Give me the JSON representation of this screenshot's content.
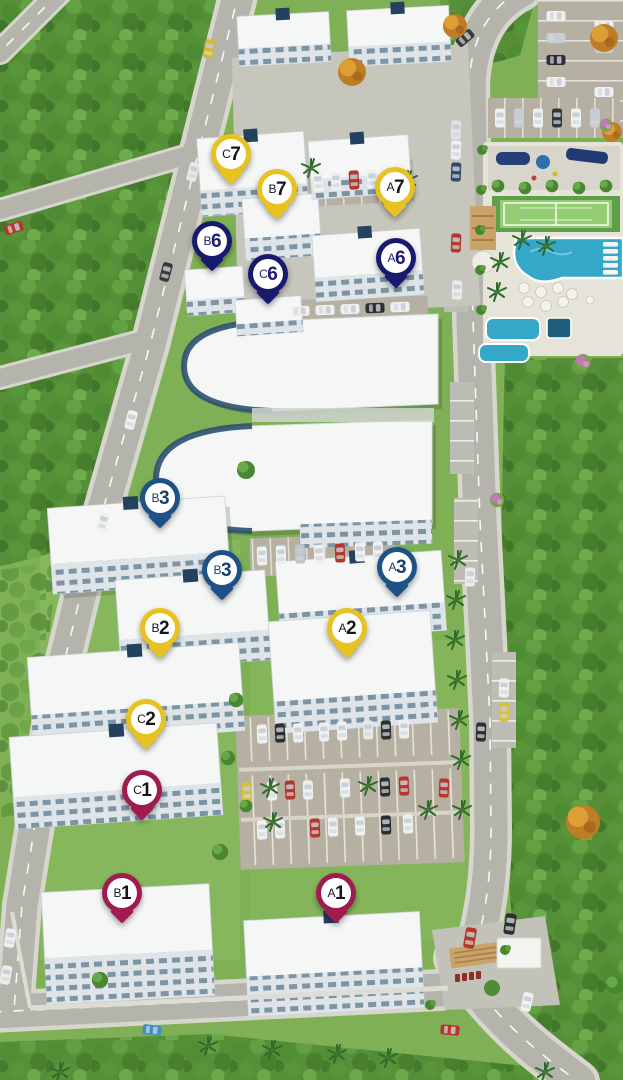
{
  "app": {
    "view": "residential-complex-masterplan-aerial-render"
  },
  "palette": {
    "grass": "#7fb055",
    "grass_light": "#8fbe64",
    "forest_base": "#568f38",
    "road": "#b4b4ac",
    "road_curb": "#d6d6cd",
    "road_line": "#ffffff",
    "parking": "#b6b0a3",
    "building": "#f5f7f6",
    "building_facade": "#dee4e7",
    "building_accent": "#24415e",
    "pool": "#35a7c8",
    "deck": "#e6e3d8",
    "court": "#93cc72",
    "canopy_wood": "#c9a36a"
  },
  "pin_groups": {
    "yellow": {
      "color": "#e7c220",
      "text": "#15151a"
    },
    "navy": {
      "color": "#181a6e",
      "text": "#1b1c70"
    },
    "blue": {
      "color": "#1e5287",
      "text": "#16406e"
    },
    "burgundy": {
      "color": "#a01b50",
      "text": "#15151a"
    }
  },
  "pins": [
    {
      "id": "C7",
      "letter": "C",
      "number": "7",
      "group": "yellow",
      "x": 231,
      "y": 154
    },
    {
      "id": "B7",
      "letter": "B",
      "number": "7",
      "group": "yellow",
      "x": 277,
      "y": 189
    },
    {
      "id": "A7",
      "letter": "A",
      "number": "7",
      "group": "yellow",
      "x": 395,
      "y": 187
    },
    {
      "id": "B6",
      "letter": "B",
      "number": "6",
      "group": "navy",
      "x": 212,
      "y": 241
    },
    {
      "id": "C6",
      "letter": "C",
      "number": "6",
      "group": "navy",
      "x": 268,
      "y": 274
    },
    {
      "id": "A6",
      "letter": "A",
      "number": "6",
      "group": "navy",
      "x": 396,
      "y": 258
    },
    {
      "id": "B3-north",
      "letter": "B",
      "number": "3",
      "group": "blue",
      "x": 160,
      "y": 498
    },
    {
      "id": "B3-south",
      "letter": "B",
      "number": "3",
      "group": "blue",
      "x": 222,
      "y": 570
    },
    {
      "id": "A3",
      "letter": "A",
      "number": "3",
      "group": "blue",
      "x": 397,
      "y": 567
    },
    {
      "id": "B2",
      "letter": "B",
      "number": "2",
      "group": "yellow",
      "x": 160,
      "y": 628
    },
    {
      "id": "A2",
      "letter": "A",
      "number": "2",
      "group": "yellow",
      "x": 347,
      "y": 628
    },
    {
      "id": "C2",
      "letter": "C",
      "number": "2",
      "group": "yellow",
      "x": 146,
      "y": 719
    },
    {
      "id": "C1",
      "letter": "C",
      "number": "1",
      "group": "burgundy",
      "x": 142,
      "y": 790
    },
    {
      "id": "B1",
      "letter": "B",
      "number": "1",
      "group": "burgundy",
      "x": 122,
      "y": 893
    },
    {
      "id": "A1",
      "letter": "A",
      "number": "1",
      "group": "burgundy",
      "x": 336,
      "y": 893
    }
  ],
  "amenities": [
    "parking-lot",
    "playground",
    "tennis-court",
    "swimming-pool",
    "kids-pool",
    "pool-bar",
    "entrance-gate"
  ]
}
